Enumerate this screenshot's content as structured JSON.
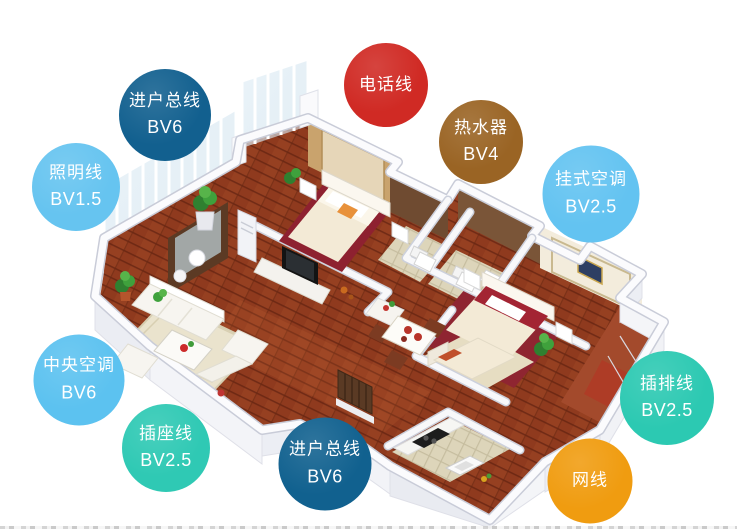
{
  "badges": [
    {
      "id": "incoming-main-line-top",
      "label": "进户总线",
      "spec": "BV6",
      "color": "#12608f"
    },
    {
      "id": "lighting-line",
      "label": "照明线",
      "spec": "BV1.5",
      "color": "#66c4f0"
    },
    {
      "id": "telephone-line",
      "label": "电话线",
      "spec": "",
      "color": "#d02a24"
    },
    {
      "id": "water-heater",
      "label": "热水器",
      "spec": "BV4",
      "color": "#9a6424"
    },
    {
      "id": "wall-mounted-ac",
      "label": "挂式空调",
      "spec": "BV2.5",
      "color": "#63c3f1"
    },
    {
      "id": "central-ac",
      "label": "中央空调",
      "spec": "BV6",
      "color": "#5cc2f0"
    },
    {
      "id": "socket-line",
      "label": "插座线",
      "spec": "BV2.5",
      "color": "#2fc9b4"
    },
    {
      "id": "incoming-main-line-bottom",
      "label": "进户总线",
      "spec": "BV6",
      "color": "#11618f"
    },
    {
      "id": "power-strip-line",
      "label": "插排线",
      "spec": "BV2.5",
      "color": "#2cc9b2"
    },
    {
      "id": "network-cable",
      "label": "网线",
      "spec": "",
      "color": "#f09c10"
    }
  ],
  "illustration": {
    "type": "isometric-apartment-floor-plan",
    "palette": {
      "wood_floor": "#8f3a1e",
      "wall_white": "#f6f6f9",
      "carpet_beige": "#eae3cd",
      "bed_red": "#8e2130",
      "wallpaper_tan": "#c9a36d",
      "wallpaper_brown": "#6f4b31",
      "plant_green": "#3f9b3a",
      "balcony_tile": "#a34a2c"
    }
  }
}
